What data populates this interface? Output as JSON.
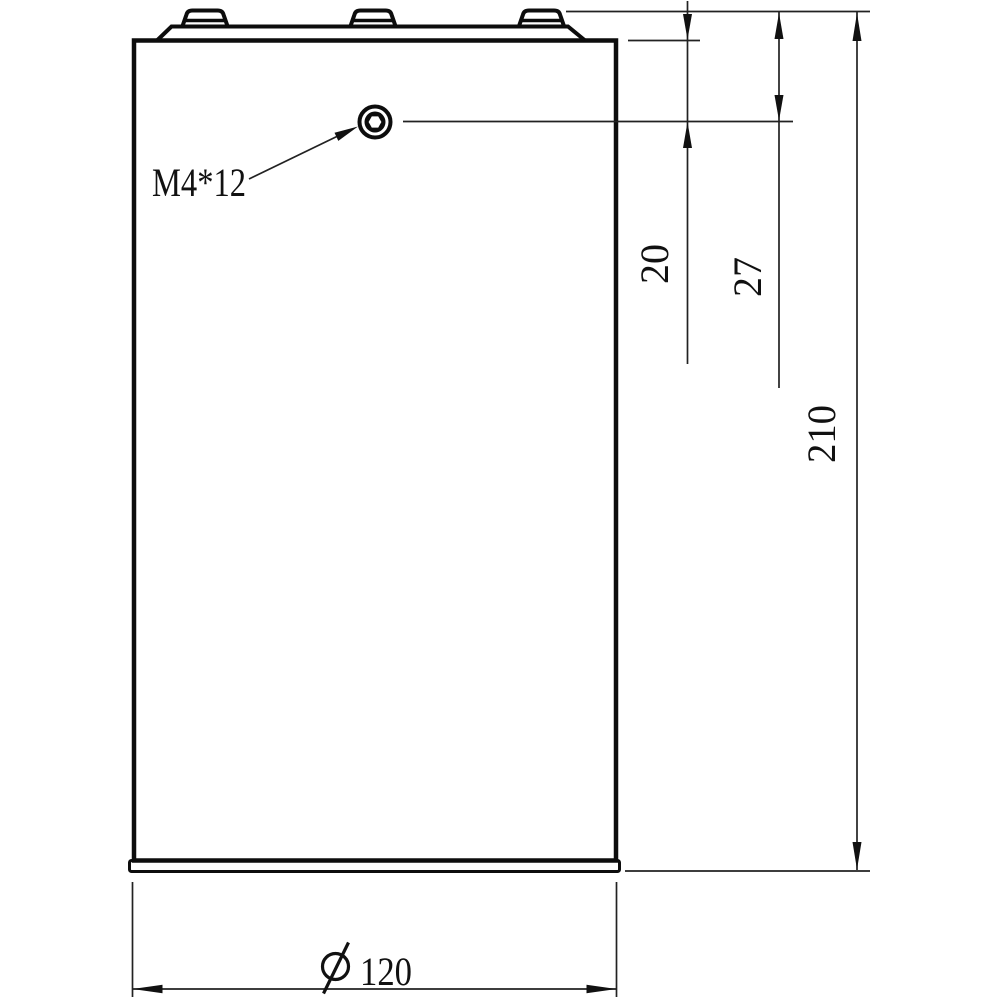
{
  "drawing": {
    "title": "cylindrical cell side view technical drawing",
    "callout": {
      "label": "M4*12"
    },
    "dimensions": {
      "screw_center_from_body_top": "20",
      "screw_center_from_terminal_top": "27",
      "overall_height": "210",
      "bottom_diameter": {
        "symbol": "⌀",
        "value": "120"
      }
    },
    "colors": {
      "line": "#0d0d0d",
      "background": "#ffffff"
    }
  }
}
